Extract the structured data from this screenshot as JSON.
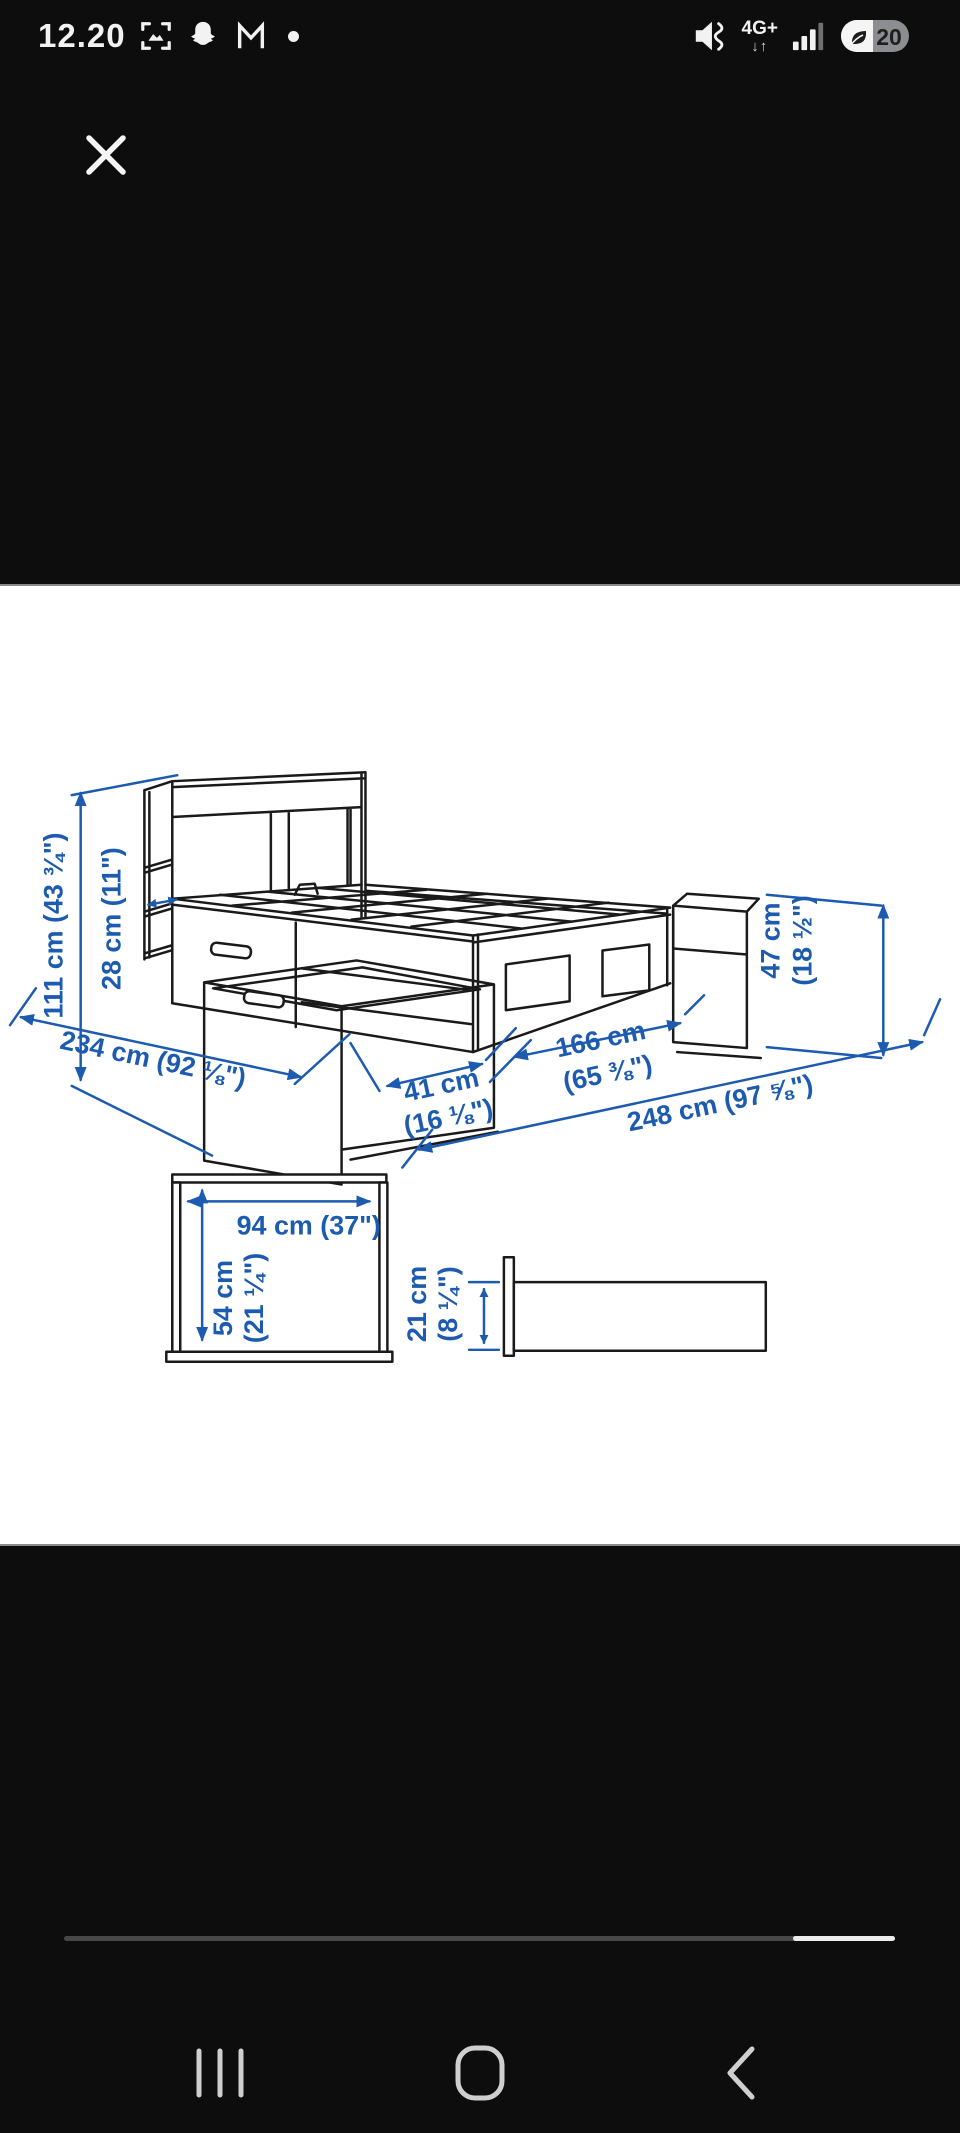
{
  "colors": {
    "accent_blue": "#1d5bb0",
    "line": "#1a1a1a",
    "panel_bg": "#ffffff",
    "screen_bg": "#0d0d0d"
  },
  "status_bar": {
    "time": "12.20",
    "left_icons": [
      "screenshot-icon",
      "snapchat-icon",
      "gmail-icon",
      "notification-dot"
    ],
    "sound_mode_icon": "mute-vibrate-icon",
    "network_label": "4G+",
    "network_arrows": "↓↑",
    "signal_icon": "signal-bars-icon",
    "battery_percent": "20",
    "battery_saver_icon": "leaf-icon"
  },
  "viewer": {
    "close_icon": "close-icon",
    "content": "bed frame with storage and headboard dimension drawing",
    "scrollbar_thumb_position": "right"
  },
  "diagram": {
    "labels": {
      "total_height": "111 cm (43 ¾\")",
      "headboard_depth": "28 cm (11\")",
      "total_length": "234 cm (92 ⅛\")",
      "drawer_open_line1": "41 cm",
      "drawer_open_line2": "(16 ⅛\")",
      "bed_width_line1": "166 cm",
      "bed_width_line2": "(65 ⅜\")",
      "total_width_drawers_open": "248 cm (97 ⅝\")",
      "side_height_line1": "47 cm",
      "side_height_line2": "(18 ½\")",
      "headboard_storage_width": "94 cm (37\")",
      "headboard_storage_height_line1": "54 cm",
      "headboard_storage_height_line2": "(21 ¼\")",
      "drawer_height_line1": "21 cm",
      "drawer_height_line2": "(8 ¼\")"
    }
  },
  "nav_bar": {
    "items": [
      "recents",
      "home",
      "back"
    ]
  }
}
